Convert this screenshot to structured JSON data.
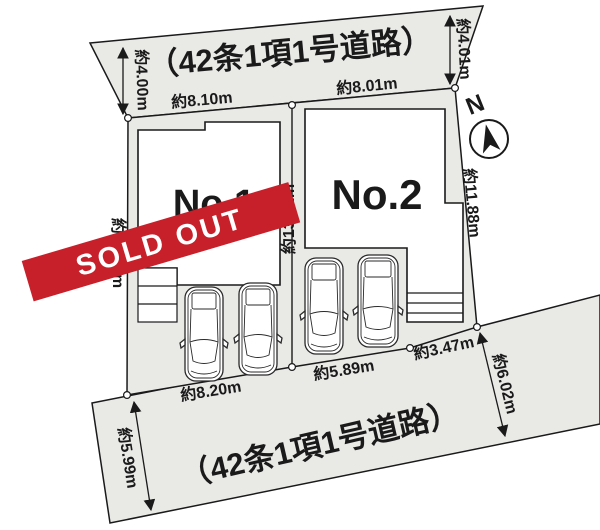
{
  "roads": {
    "top_label": "（42条1項1号道路）",
    "bottom_label": "（42条1項1号道路）"
  },
  "lots": {
    "lot1": {
      "name": "No.1",
      "banner": "SOLD OUT"
    },
    "lot2": {
      "name": "No.2"
    }
  },
  "compass": {
    "north_label": "N"
  },
  "dims": {
    "top_left_road_width": "約4.00m",
    "top_frontage_no1": "約8.10m",
    "top_frontage_no2": "約8.01m",
    "top_right_road_width": "約4.01m",
    "left_depth": "約13.78m",
    "center_depth": "約13.01m",
    "right_depth": "約11.88m",
    "bottom_frontage_no1": "約8.20m",
    "bottom_frontage_no2": "約5.89m",
    "bottom_frontage_right": "約3.47m",
    "bottom_left_road_width": "約5.99m",
    "bottom_right_road_width": "約6.02m"
  },
  "colors": {
    "road_fill": "#e9e9e6",
    "outline": "#1a1a1a",
    "banner_red": "#c8202a",
    "building_fill": "#ffffff"
  }
}
